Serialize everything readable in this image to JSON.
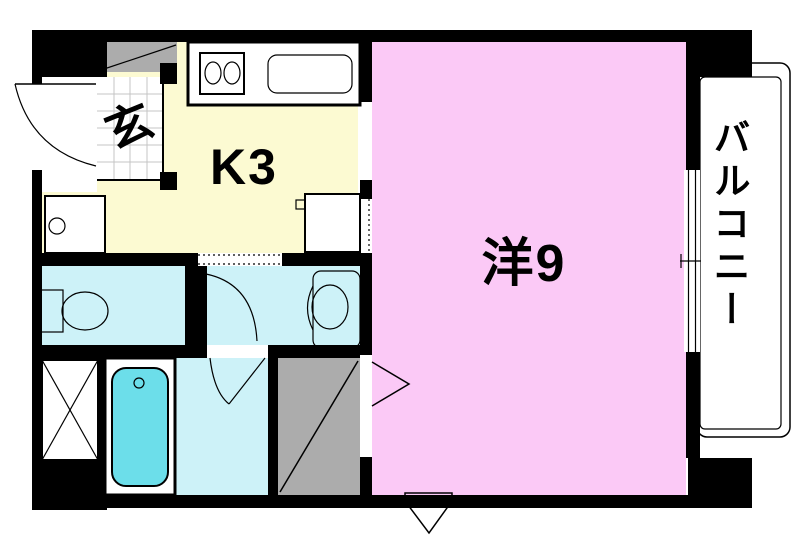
{
  "plan": {
    "type": "Japanese apartment floor plan",
    "labels": {
      "genkan": "玄",
      "kitchen": "K3",
      "living_room": "洋9",
      "balcony": "バルコニー"
    },
    "colors": {
      "background": "#FFFFFF",
      "wall": "#000000",
      "line": "#000000",
      "kitchen": "#FCFAD2",
      "living": "#FBC9F6",
      "wet_room": "#CDF2F8",
      "bathtub": "#6CDEEA",
      "closet": "#ACACAC",
      "basin": "#DBDBDB",
      "tile_grid": "#C4C4C4"
    }
  }
}
